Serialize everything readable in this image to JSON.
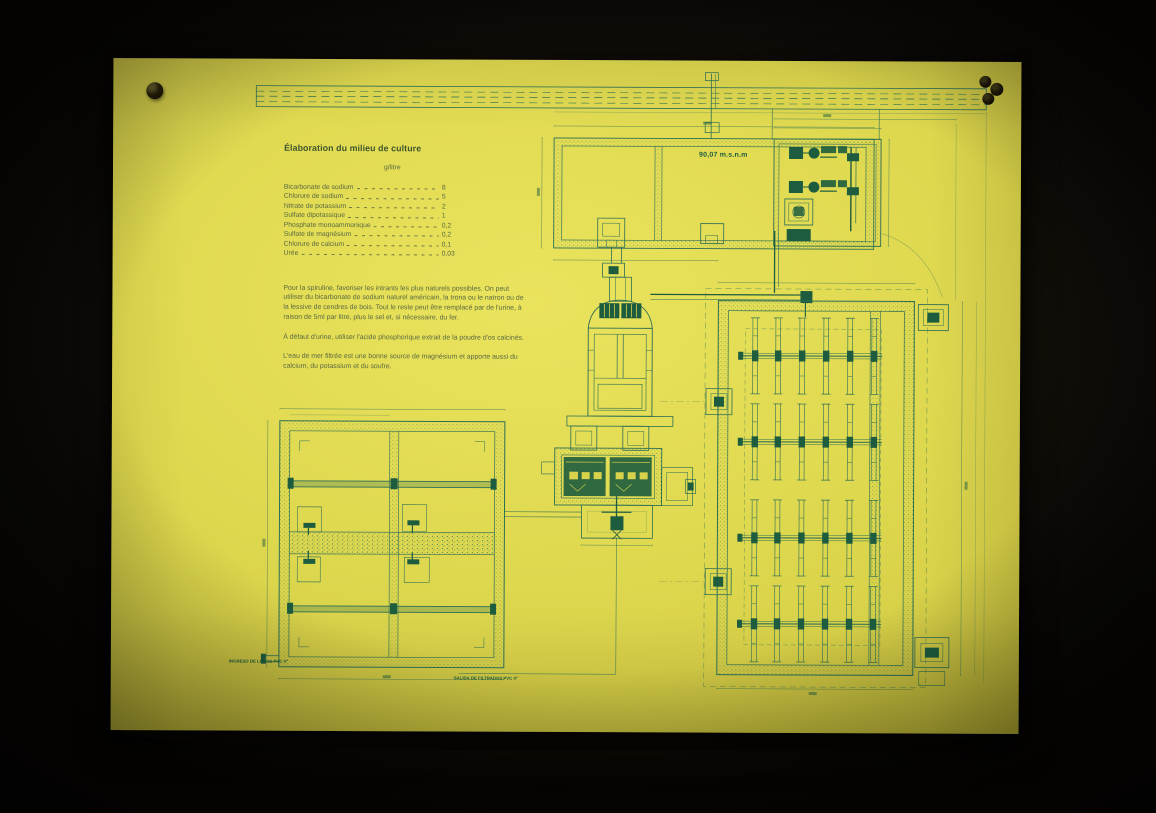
{
  "scene": {
    "colors": {
      "background": "#0a0806",
      "poster": "#ded84f",
      "poster_highlight": "#eae35d",
      "poster_edge": "#c9c23a",
      "ink": "#2e6e54",
      "ink_dark": "#1d5c3e",
      "text": "#5b6a40",
      "title": "#3e552c"
    }
  },
  "poster": {
    "title": "Élaboration du milieu de culture",
    "table": {
      "unit_header": "g/litre",
      "rows": [
        {
          "label": "Bicarbonate de sodium",
          "value": "8"
        },
        {
          "label": "Chlorure de sodium",
          "value": "5"
        },
        {
          "label": "Nitrate de potassium",
          "value": "2"
        },
        {
          "label": "Sulfate dipotassique",
          "value": "1"
        },
        {
          "label": "Phosphate monoammonique",
          "value": "0,2"
        },
        {
          "label": "Sulfate de magnésium",
          "value": "0,2"
        },
        {
          "label": "Chlorure de calcium",
          "value": "0,1"
        },
        {
          "label": "Urée",
          "value": "0,03"
        }
      ]
    },
    "paragraphs": [
      "Pour la spiruline, favoriser les intrants les plus naturels possibles. On peut utiliser du bicarbonate de sodium naturel américain, la trona ou le natron ou de la lessive de cendres de bois. Tout le reste peut être remplacé par de l'urine, à raison de 5ml par litre, plus le sel et, si nécessaire, du fer.",
      "À défaut d'urine, utiliser l'acide phosphorique extrait de la poudre d'os calcinés.",
      "L'eau de mer filtrée est une bonne source de magnésium et apporte aussi du calcium, du potassium et du soufre."
    ],
    "drawing_labels": {
      "elevation": "90,07 m.s.n.m",
      "sludge_inlet": "INGRESO DE LODOS PVC 4\"",
      "filtrate_outlet": "SALIDA DE FILTRADOS PVC 4\""
    }
  }
}
